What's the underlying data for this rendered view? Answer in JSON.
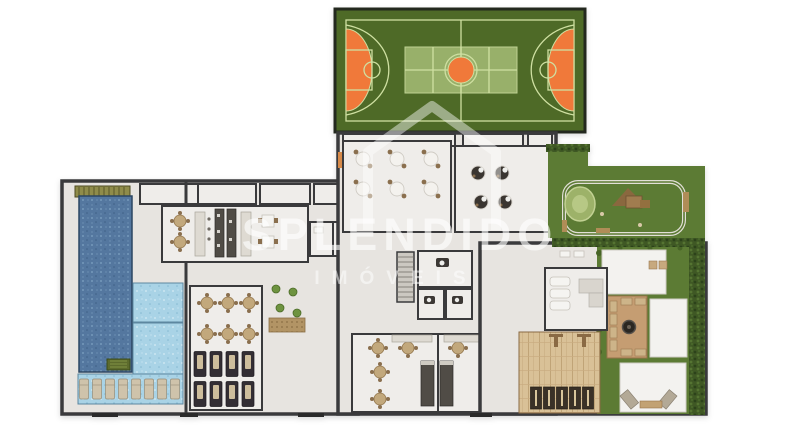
{
  "watermark": {
    "brand": "SPLENDIDO",
    "tagline": "IMÓVEIS"
  },
  "plan": {
    "type": "residential-amenities-floor-plan",
    "areas": [
      {
        "name": "basketball-court",
        "color": "#4e6a27"
      },
      {
        "name": "court-end-zones",
        "color": "#f0793a"
      },
      {
        "name": "court-volleyball-overlay",
        "color": "#a3ba74"
      },
      {
        "name": "lap-pool",
        "color": "#54779f"
      },
      {
        "name": "kids-pool",
        "color": "#a9d3e6"
      },
      {
        "name": "wet-deck-loungers",
        "color": "#cfc3ab"
      },
      {
        "name": "lounge-tables-room",
        "color": "#efedea"
      },
      {
        "name": "gourmet-kitchen",
        "color": "#504c46"
      },
      {
        "name": "dining-room",
        "color": "#efedea"
      },
      {
        "name": "games-room",
        "color": "#3a3530"
      },
      {
        "name": "restrooms-core",
        "color": "#efedea"
      },
      {
        "name": "party-rooms",
        "color": "#efedea"
      },
      {
        "name": "sauna-relax-room",
        "color": "#f5f4f1"
      },
      {
        "name": "wood-deck",
        "color": "#d9c197"
      },
      {
        "name": "fire-pit-lounge",
        "color": "#c59d72"
      },
      {
        "name": "playground-lawn",
        "color": "#5c7b34"
      },
      {
        "name": "hedges",
        "color": "#3f5824"
      },
      {
        "name": "garden-patios",
        "color": "#f3f2ef"
      }
    ]
  },
  "colors": {
    "wall": "#3a3a3c",
    "floor": "#e7e4e0",
    "room": "#efedea",
    "court-green": "#4e6a27",
    "court-line": "#cfe0a2",
    "orange": "#f0793a",
    "volley": "#a3ba74",
    "lawn": "#5c7b34",
    "hedge": "#3f5824",
    "pool-dark": "#54779f",
    "pool-light": "#a9d3e6",
    "wood": "#d9c197",
    "deck-tan": "#c59d72",
    "beige": "#c2a87c",
    "brown": "#8a6f4e",
    "dark-furn": "#36302e",
    "white-furn": "#f5f4f1",
    "counter": "#504c46",
    "counter-light": "#dedad2",
    "patio": "#f3f2ef"
  }
}
